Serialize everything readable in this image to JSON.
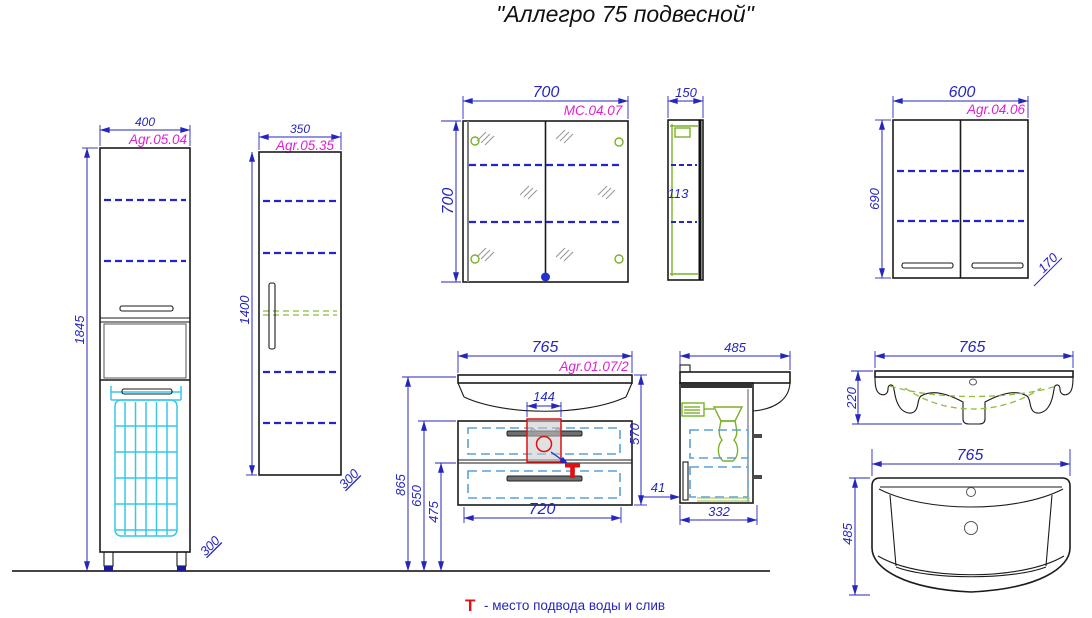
{
  "title": "\"Аллегро 75 подвесной\"",
  "legend": {
    "symbol": "Т",
    "text": "- место подвода воды и слив"
  },
  "colors": {
    "dimension_blue": "#2626bf",
    "article_magenta": "#df1fd1",
    "outline_black": "#1b1b1b",
    "basket_cyan": "#35c8e8",
    "drawer_dash_blue": "#58a0d8",
    "fitting_green": "#7ab227",
    "accent_red": "#e01111"
  },
  "views": {
    "tall": {
      "label": "Agr.05.04",
      "width": "400",
      "height": "1845",
      "depth": "300"
    },
    "column": {
      "label": "Agr.05.35",
      "width": "350",
      "height": "1400",
      "depth": "300"
    },
    "mirror_front": {
      "label": "MC.04.07",
      "width": "700",
      "height": "700"
    },
    "mirror_side": {
      "depth": "150",
      "shelf_depth": "113"
    },
    "wall": {
      "label": "Agr.04.06",
      "width": "600",
      "height": "690",
      "depth": "170"
    },
    "vanity_front": {
      "label": "Agr.01.07/2",
      "width": "765",
      "height": "570",
      "drawer_width": "720",
      "siphon_zone_width": "144",
      "mount_height": "865",
      "upper_drawer_height": "650",
      "lower_drawer_height": "475"
    },
    "vanity_side": {
      "depth": "485",
      "body_depth": "332",
      "plinth_offset": "41"
    },
    "basin_front": {
      "width": "765",
      "height": "220"
    },
    "basin_top": {
      "width": "765",
      "depth": "485"
    }
  }
}
